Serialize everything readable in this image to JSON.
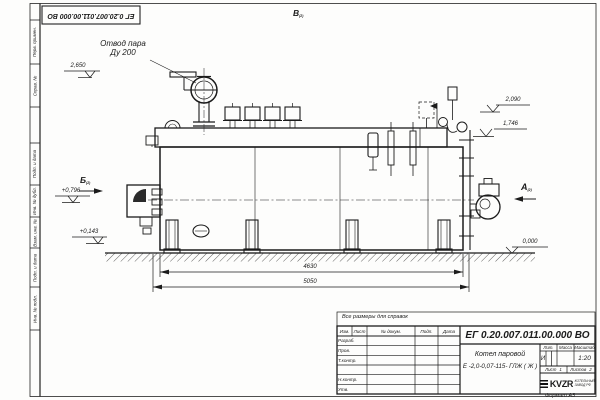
{
  "colors": {
    "ink": "#1b1b1b",
    "paper": "#fdfdfc"
  },
  "corner_stamp": {
    "number": "ЕГ 0.20.007.011.00.000  ВО"
  },
  "frame": {
    "left_labels": [
      "Перв. примен.",
      "Справ. №",
      "Подп. и дата",
      "Инв. № дубл.",
      "Взам. инв. №",
      "Подп. и дата",
      "Инв. № подл."
    ]
  },
  "annotations": {
    "steam_outlet_line1": "Отвод пара",
    "steam_outlet_line2": "Ду 200",
    "view_a": "А",
    "view_b": "Б",
    "view_v": "В",
    "view_sub": "(2)",
    "note": "Все размеры для справок"
  },
  "elevations": {
    "e2650": "2,650",
    "e0796": "+0,796",
    "e0143": "+0,143",
    "e2090": "2,090",
    "e1746": "1,746",
    "e0000": "0,000"
  },
  "dimensions": {
    "d4630": "4630",
    "d5050": "5050"
  },
  "title_block": {
    "doc_number": "ЕГ 0.20.007.011.00.000  ВО",
    "name_line1": "Котел паровой",
    "name_line2": "Е -2,0-0,07-115- ГЛЖ ( Ж )",
    "header": {
      "izm": "Изм.",
      "list": "Лист",
      "doc": "№ докум.",
      "podp": "Подп.",
      "data": "Дата"
    },
    "rows": [
      "Разраб.",
      "Пров.",
      "Т.контр.",
      "",
      "Н.контр.",
      "Утв."
    ],
    "lit_label": "Лит.",
    "mass_label": "Масса",
    "scale_label": "Масштаб",
    "lit_value": "И",
    "scale_value": "1:20",
    "sheet_label": "Лист",
    "sheet_value": "1",
    "sheets_label": "Листов",
    "sheets_value": "2",
    "logo_text": "KVZR",
    "logo_sub1": "КОТЕЛЬНЫЙ",
    "logo_sub2": "ЗАВОД РФ",
    "format": "Формат  А3"
  }
}
